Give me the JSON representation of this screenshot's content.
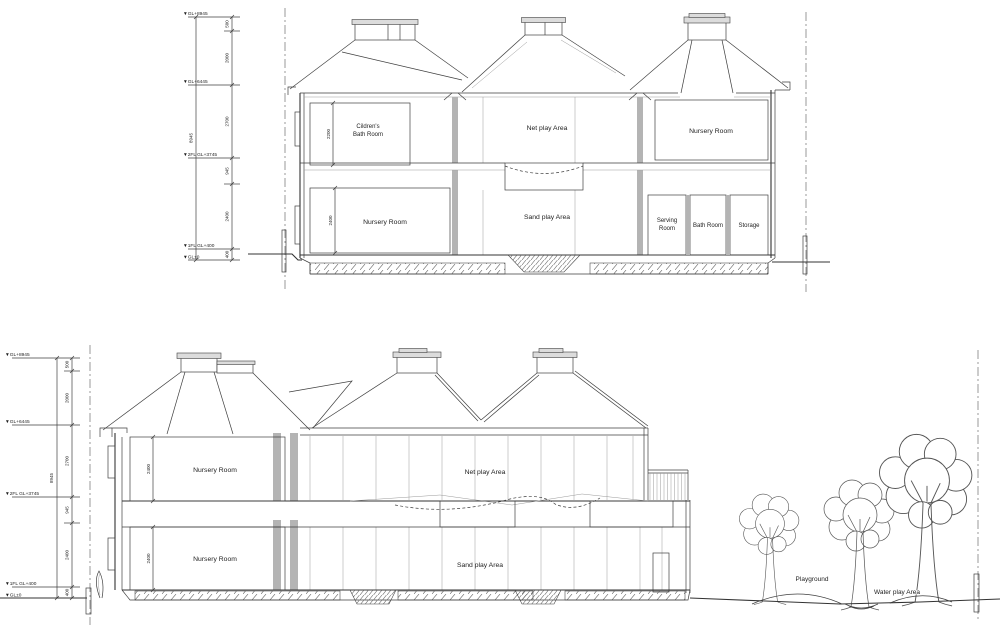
{
  "drawing": {
    "levels": {
      "l1": "▼GL+8945",
      "l2": "▼GL+6445",
      "l3": "▼2FL GL+3745",
      "l4": "▼1FL GL+400",
      "l5": "▼GL±0"
    },
    "dims": {
      "seg1": "500",
      "seg2": "2000",
      "seg3": "2700",
      "seg4": "945",
      "seg5": "2400",
      "seg6": "400",
      "total": "8945",
      "bath_height": "2200",
      "room_height": "2400"
    },
    "top": {
      "bath_l1": "Cildren's",
      "bath_l2": "Bath Room",
      "net": "Net play Area",
      "nursery_2f": "Nursery Room",
      "nursery_1f": "Nursery Room",
      "sand": "Sand play Area",
      "serving_l1": "Serving",
      "serving_l2": "Room",
      "bathroom": "Bath Room",
      "storage": "Storage"
    },
    "bottom": {
      "nursery_2f": "Nursery Room",
      "net": "Net play Area",
      "nursery_1f": "Nursery Room",
      "sand": "Sand play Area",
      "playground": "Playground",
      "waterplay": "Water play Area"
    }
  }
}
